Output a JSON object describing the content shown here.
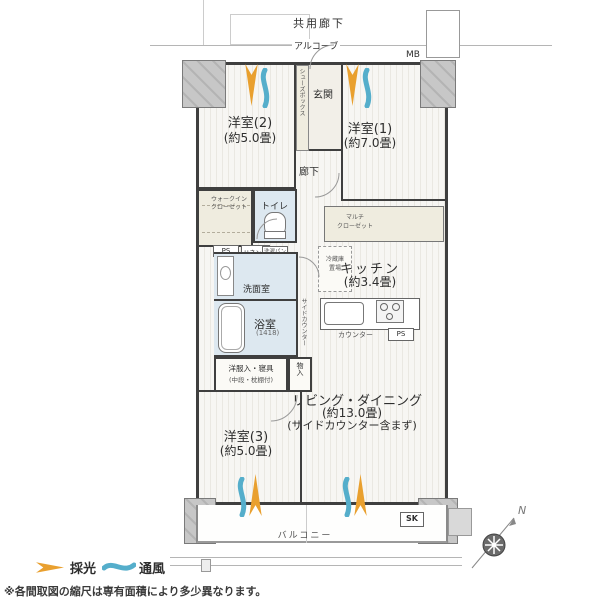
{
  "labels": {
    "common_corridor": "共用廊下",
    "alcove": "アルコーブ",
    "mb": "MB",
    "entrance": "玄関",
    "shoe_box": "シューズボックス",
    "hallway": "廊下",
    "bedroom2_name": "洋室(2)",
    "bedroom2_size": "(約5.0畳)",
    "bedroom1_name": "洋室(1)",
    "bedroom1_size": "(約7.0畳)",
    "wic_line1": "ウォークイン",
    "wic_line2": "クローゼット",
    "toilet": "トイレ",
    "ps1": "PS",
    "linen": "リネン庫",
    "laundry_pan": "洗濯パン",
    "washroom": "洗面室",
    "bath_name": "浴室",
    "bath_size": "(1418)",
    "multi_closet_line1": "マルチ",
    "multi_closet_line2": "クローゼット",
    "fridge_line1": "冷蔵庫",
    "fridge_line2": "置場",
    "kitchen_name": "キッチン",
    "kitchen_size": "(約3.4畳)",
    "counter": "カウンター",
    "ps2": "PS",
    "side_counter": "サイドカウンター",
    "futon_line1": "洋服入・寝具",
    "futon_line2": "(中段・枕棚付)",
    "storage": "物入",
    "living_name": "リビング・ダイニング",
    "living_size": "(約13.0畳)",
    "living_note": "(サイドカウンター含まず)",
    "bedroom3_name": "洋室(3)",
    "bedroom3_size": "(約5.0畳)",
    "balcony": "バルコニー",
    "sk": "SK",
    "compass_north": "N"
  },
  "legend": {
    "daylight": "採光",
    "ventilation": "通風"
  },
  "footnote": "※各間取図の縮尺は専有面積により多少異なります。",
  "colors": {
    "daylight_orange": "#e9a02f",
    "ventilation_blue": "#55aecb",
    "wall": "#3f3f3f",
    "wet_room": "#dde8f0",
    "closet_beige": "#efecdf"
  }
}
